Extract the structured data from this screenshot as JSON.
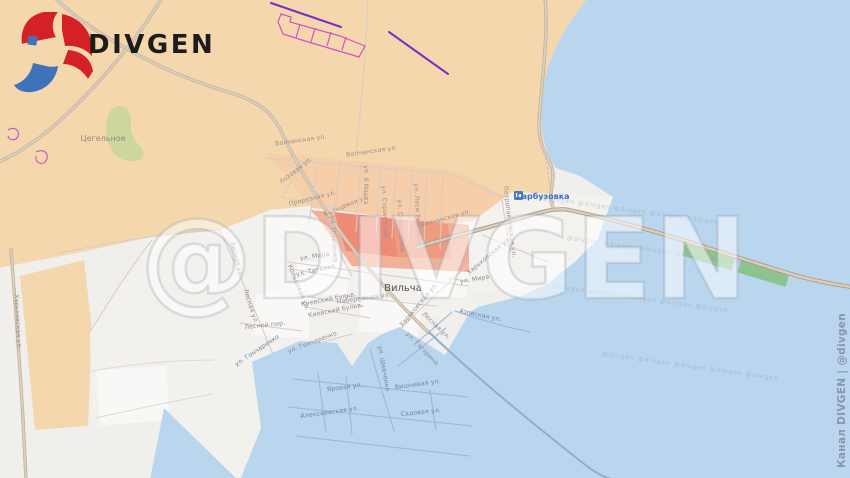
{
  "branding": {
    "logo_text": "DIVGEN",
    "watermark_big": "@DIVGEN",
    "watermark_tile": "@divgen   @divgen   @divgen   @divgen   @divgen",
    "credit_vertical": "Канал DIVGEN | @divgen"
  },
  "map": {
    "settlements": [
      {
        "name": "Цегельное",
        "x": 103,
        "y": 141,
        "size": 8,
        "color": "#8f8a84",
        "icon": false
      },
      {
        "name": "Вильча",
        "x": 403,
        "y": 291,
        "size": 10,
        "color": "#50505a",
        "icon": false
      },
      {
        "name": "Гарбузовка",
        "x": 527,
        "y": 199,
        "size": 8,
        "color": "#3a6cc5",
        "icon": true
      }
    ],
    "transit_stop_icon": "bus-stop-icon",
    "street_labels": [
      {
        "t": "Волчанская ул.",
        "x": 301,
        "y": 142,
        "r": -8,
        "c": "tan"
      },
      {
        "t": "Волчанская ул.",
        "x": 372,
        "y": 153,
        "r": -8,
        "c": "tan"
      },
      {
        "t": "Лозовая ул.",
        "x": 297,
        "y": 172,
        "r": -38,
        "c": "tan"
      },
      {
        "t": "Прорезная ул.",
        "x": 313,
        "y": 200,
        "r": -14,
        "c": "tan"
      },
      {
        "t": "ул. 8 Марта",
        "x": 364,
        "y": 185,
        "r": 90,
        "c": "tan"
      },
      {
        "t": "Кольцевая ул.",
        "x": 347,
        "y": 207,
        "r": -22,
        "c": "tan"
      },
      {
        "t": "ул. Строителей",
        "x": 383,
        "y": 212,
        "r": 87,
        "c": "tan"
      },
      {
        "t": "ул. Строителей",
        "x": 399,
        "y": 226,
        "r": 87,
        "c": "tan"
      },
      {
        "t": "ул. Леси Украинки",
        "x": 416,
        "y": 215,
        "r": 87,
        "c": "tan"
      },
      {
        "t": "Волчанская ул.",
        "x": 446,
        "y": 220,
        "r": -16,
        "c": "tan"
      },
      {
        "t": "Петропавловская ул.",
        "x": 508,
        "y": 222,
        "r": 83,
        "c": "tan"
      },
      {
        "t": "ул. Шевченко",
        "x": 332,
        "y": 239,
        "r": 86,
        "c": "tan"
      },
      {
        "t": "Харьковская ул.",
        "x": 16,
        "y": 322,
        "r": 87,
        "c": "tan"
      },
      {
        "t": "ул. Мира",
        "x": 315,
        "y": 258,
        "r": -9,
        "c": "area"
      },
      {
        "t": "ул. Титенко",
        "x": 316,
        "y": 272,
        "r": -13,
        "c": "area"
      },
      {
        "t": "Кольцевая ул.",
        "x": 297,
        "y": 288,
        "r": 68,
        "c": "area"
      },
      {
        "t": "Лесная ул.",
        "x": 235,
        "y": 260,
        "r": 74,
        "c": "area"
      },
      {
        "t": "Лесная ул.",
        "x": 249,
        "y": 307,
        "r": 72,
        "c": "area"
      },
      {
        "t": "Киевский бульв.",
        "x": 329,
        "y": 301,
        "r": -11,
        "c": "area"
      },
      {
        "t": "Киевский бульв.",
        "x": 336,
        "y": 312,
        "r": -11,
        "c": "area"
      },
      {
        "t": "Набережная ул.",
        "x": 364,
        "y": 300,
        "r": -8,
        "c": "area"
      },
      {
        "t": "Лесной пер.",
        "x": 265,
        "y": 327,
        "r": -6,
        "c": "area"
      },
      {
        "t": "ул. Гончаренко",
        "x": 313,
        "y": 344,
        "r": -21,
        "c": "area"
      },
      {
        "t": "Харьковская ул.",
        "x": 420,
        "y": 306,
        "r": -50,
        "c": "area"
      },
      {
        "t": "Харьковская ул.",
        "x": 490,
        "y": 257,
        "r": -40,
        "c": "area"
      },
      {
        "t": "ул. Мира",
        "x": 475,
        "y": 281,
        "r": -10,
        "c": "area"
      },
      {
        "t": "Лесная ул.",
        "x": 435,
        "y": 327,
        "r": 44,
        "c": "area"
      },
      {
        "t": "ул. Гагарина",
        "x": 421,
        "y": 350,
        "r": 46,
        "c": "area"
      },
      {
        "t": "Азовская ул.",
        "x": 480,
        "y": 317,
        "r": 12,
        "c": "flood"
      },
      {
        "t": "ул. Шевченко",
        "x": 382,
        "y": 369,
        "r": 80,
        "c": "flood"
      },
      {
        "t": "ул. Гончаренко",
        "x": 258,
        "y": 352,
        "r": -34,
        "c": "flood"
      },
      {
        "t": "Яровая ул.",
        "x": 345,
        "y": 389,
        "r": -8,
        "c": "flood"
      },
      {
        "t": "Вишневая ул.",
        "x": 418,
        "y": 386,
        "r": -8,
        "c": "flood"
      },
      {
        "t": "Садовая ул.",
        "x": 421,
        "y": 414,
        "r": -6,
        "c": "flood"
      },
      {
        "t": "Алексеевская ул.",
        "x": 330,
        "y": 414,
        "r": -8,
        "c": "flood"
      }
    ],
    "colors": {
      "land": "#f5d7ae",
      "water": "#b9d6ee",
      "settlement_area": "#f3f1ee",
      "highlight_light": "#f6ceaa",
      "highlight_medium": "#f2b098",
      "highlight_strong": "#ee8a76",
      "greenery": "#cdd69e",
      "dam_green": "#8cc48e",
      "power_line": "#7b2fbe",
      "greenhouse_outline": "#cb54c8",
      "logo_red": "#d42127",
      "logo_blue": "#3f72b8",
      "transit_blue": "#4a7cc8"
    }
  }
}
